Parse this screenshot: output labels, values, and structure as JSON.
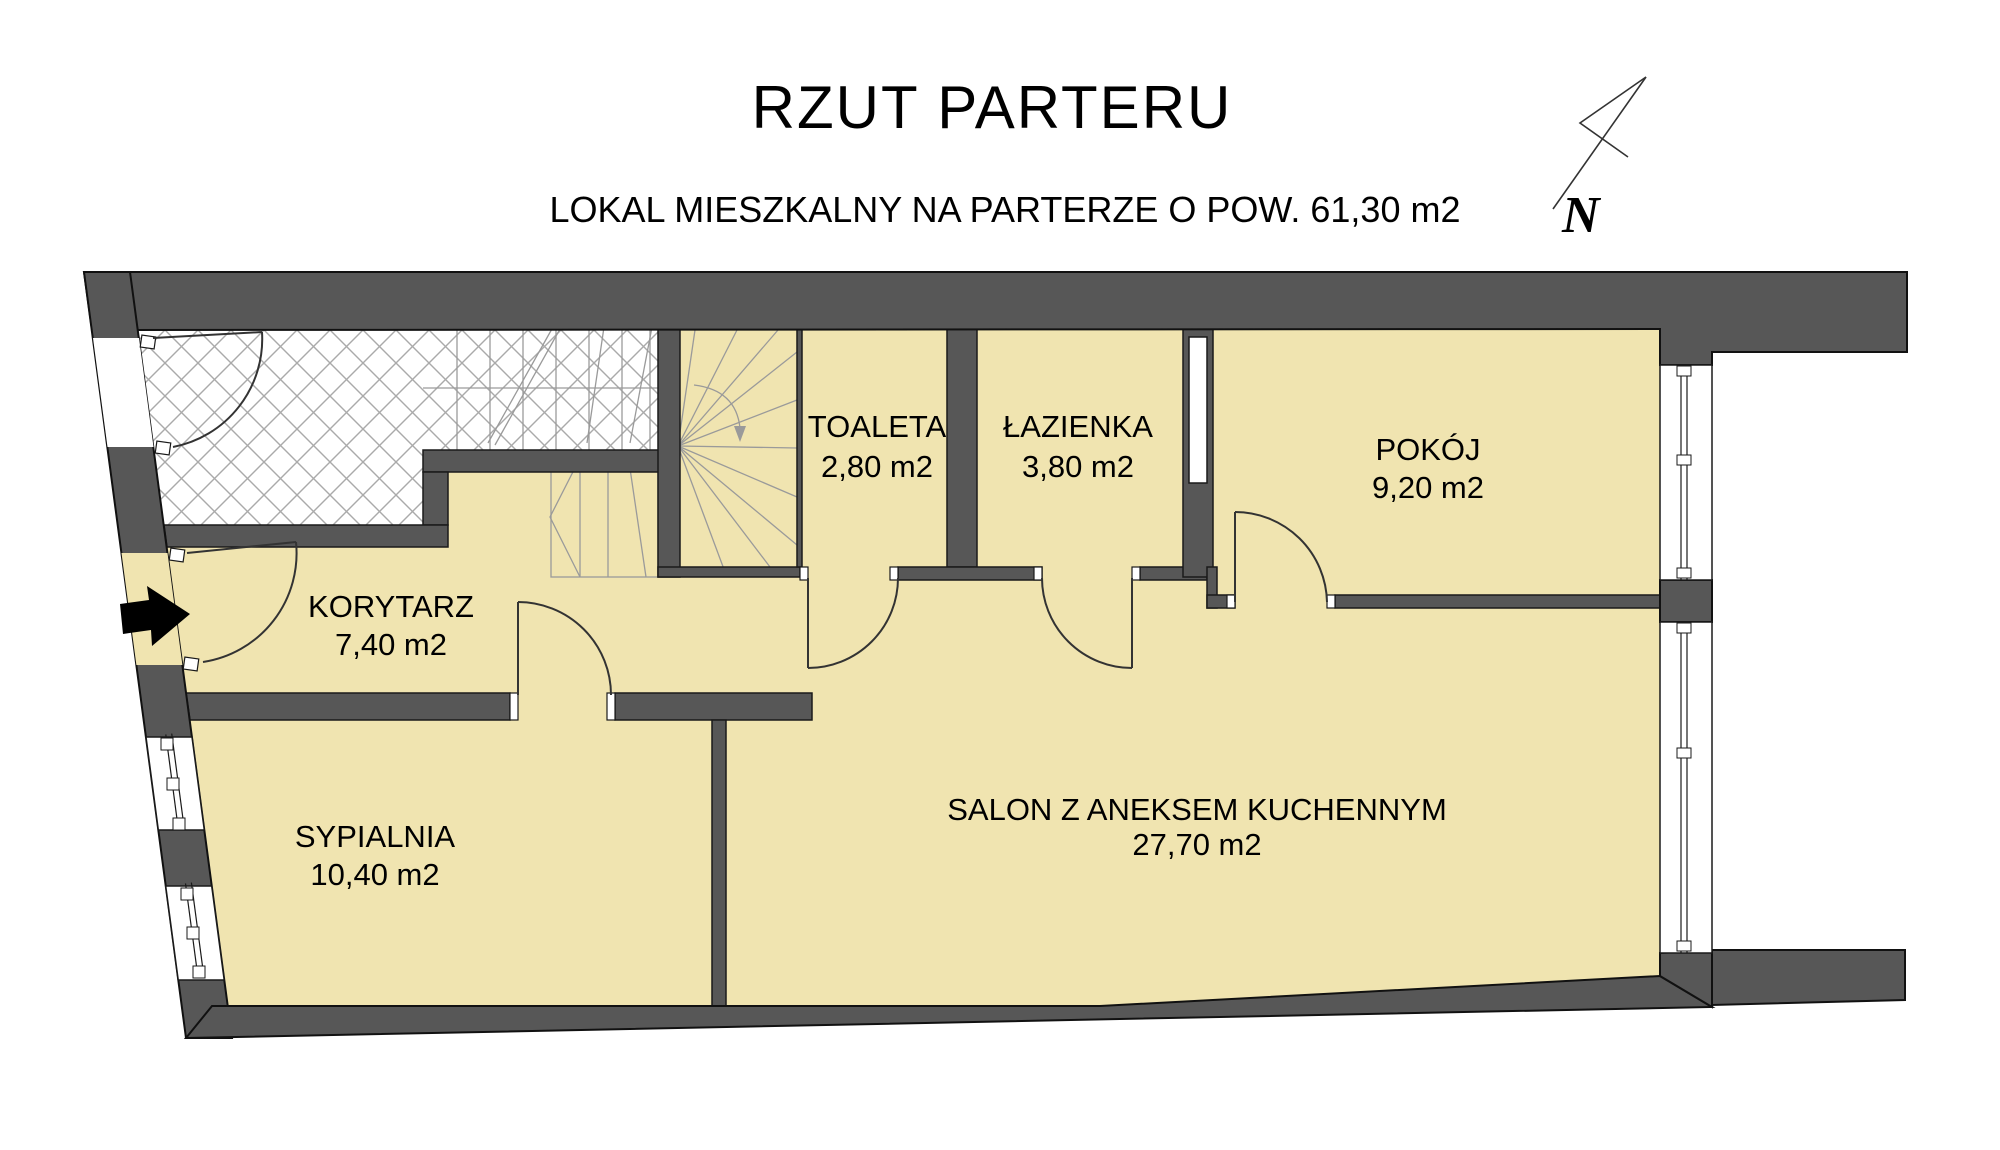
{
  "title": "RZUT PARTERU",
  "subtitle": "LOKAL MIESZKALNY NA PARTERZE O POW. 61,30 m2",
  "north": {
    "label": "N"
  },
  "rooms": [
    {
      "id": "korytarz",
      "name": "KORYTARZ",
      "area": "7,40 m2"
    },
    {
      "id": "toaleta",
      "name": "TOALETA",
      "area": "2,80 m2"
    },
    {
      "id": "lazienka",
      "name": "ŁAZIENKA",
      "area": "3,80 m2"
    },
    {
      "id": "pokoj",
      "name": "POKÓJ",
      "area": "9,20 m2"
    },
    {
      "id": "sypialnia",
      "name": "SYPIALNIA",
      "area": "10,40 m2"
    },
    {
      "id": "salon",
      "name": "SALON Z ANEKSEM KUCHENNYM",
      "area": "27,70 m2"
    }
  ],
  "colors": {
    "wall": "#575757",
    "room_fill": "#F0E4B0",
    "hatch_line": "#AAAAAA",
    "outline": "#1A1A1A",
    "arrow": "#000000"
  }
}
